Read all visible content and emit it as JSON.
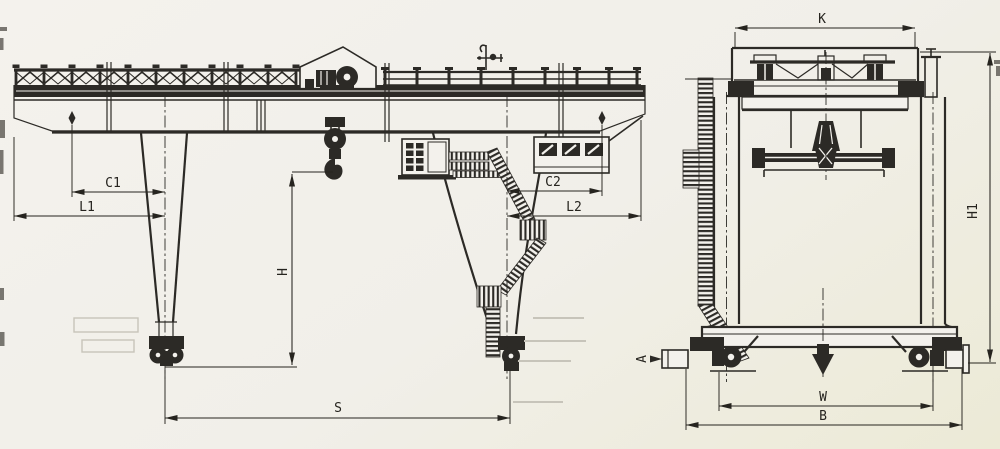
{
  "drawing": {
    "description": "Two-view general arrangement engineering drawing of a rail-mounted gantry crane",
    "colors": {
      "paper": "#f2f0ea",
      "ink": "#2c2a26",
      "faint": "#c7c4ba"
    },
    "views": {
      "front_elevation": {
        "dimension_labels": [
          "C1",
          "L1",
          "H",
          "S",
          "C2",
          "L2"
        ]
      },
      "side_elevation": {
        "dimension_labels": [
          "K",
          "H1",
          "A",
          "W",
          "B"
        ]
      }
    },
    "labels": {
      "c1": "C1",
      "l1": "L1",
      "h": "H",
      "s": "S",
      "c2": "C2",
      "l2": "L2",
      "k": "K",
      "h1": "H1",
      "a": "A",
      "w": "W",
      "b": "B"
    }
  }
}
